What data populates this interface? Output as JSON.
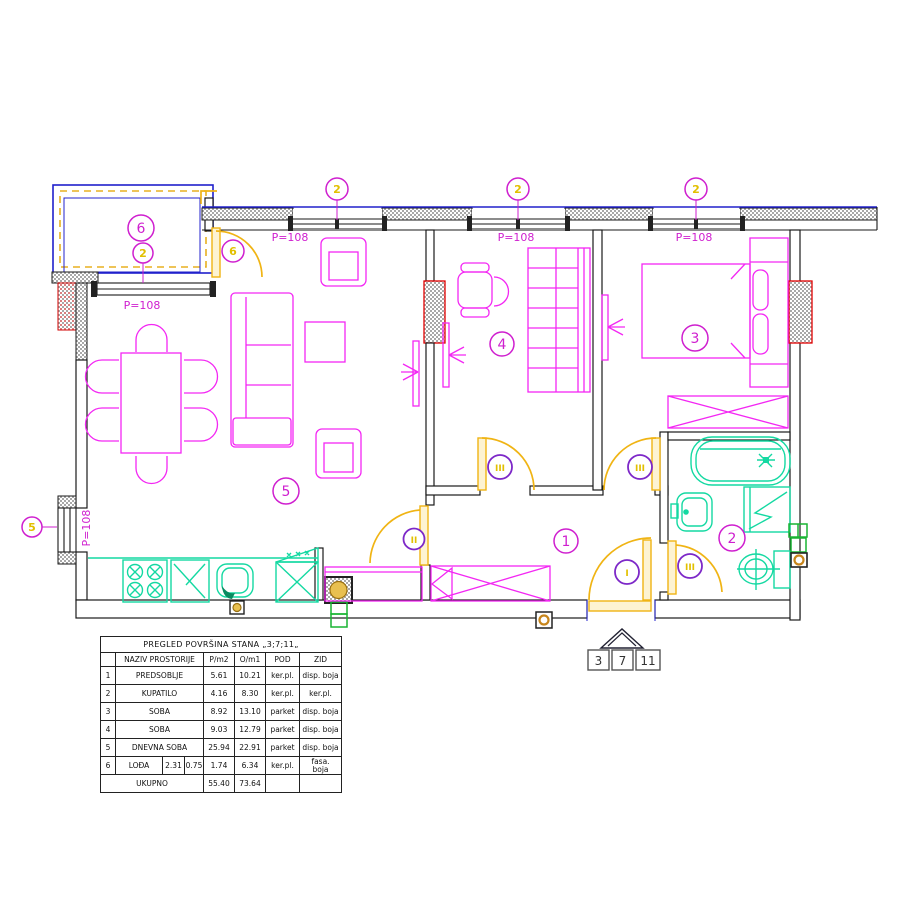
{
  "plan": {
    "window_label": "P=108",
    "window_markers": {
      "top1": "2",
      "top2": "2",
      "top3": "2",
      "loggia": "2",
      "west": "5",
      "balcony_door": "6"
    },
    "room_labels": {
      "hall": "1",
      "bath": "2",
      "bedroom": "3",
      "room4": "4",
      "living": "5",
      "loggia": "6"
    },
    "door_markers": {
      "entrance": "I",
      "living": "II",
      "room4": "III",
      "bedroom": "III",
      "bath": "III"
    },
    "apartment_numbers": [
      "3",
      "7",
      "11"
    ]
  },
  "table": {
    "title": "PREGLED POVRŠINA STANA „3;7;11„",
    "headers": {
      "name": "NAZIV PROSTORIJE",
      "p": "P/m2",
      "o": "O/m1",
      "pod": "POD",
      "zid": "ZID"
    },
    "rows": [
      {
        "n": "1",
        "name": "PREDSOBLJE",
        "p": "5.61",
        "o": "10.21",
        "pod": "ker.pl.",
        "zid": "disp. boja"
      },
      {
        "n": "2",
        "name": "KUPATILO",
        "p": "4.16",
        "o": "8.30",
        "pod": "ker.pl.",
        "zid": "ker.pl."
      },
      {
        "n": "3",
        "name": "SOBA",
        "p": "8.92",
        "o": "13.10",
        "pod": "parket",
        "zid": "disp. boja"
      },
      {
        "n": "4",
        "name": "SOBA",
        "p": "9.03",
        "o": "12.79",
        "pod": "parket",
        "zid": "disp. boja"
      },
      {
        "n": "5",
        "name": "DNEVNA SOBA",
        "p": "25.94",
        "o": "22.91",
        "pod": "parket",
        "zid": "disp. boja"
      },
      {
        "n": "6",
        "name": "LOĐA",
        "sub1": "2.31",
        "sub2": "0.75",
        "p": "1.74",
        "o": "6.34",
        "pod": "ker.pl.",
        "zid1": "fasa.",
        "zid2": "boja"
      }
    ],
    "total": {
      "label": "UKUPNO",
      "p": "55.40",
      "o": "73.64"
    }
  },
  "colors": {
    "furniture": "#f327f3",
    "doors": "#f0b414",
    "fixtures": "#14d9a2",
    "walls": "#1a1a1a",
    "windows": "#2020cc",
    "marker_purple": "#7d28c8",
    "marker_yellow": "#e2c000",
    "shaft_red": "#e00000",
    "pipes_green": "#18b432"
  }
}
